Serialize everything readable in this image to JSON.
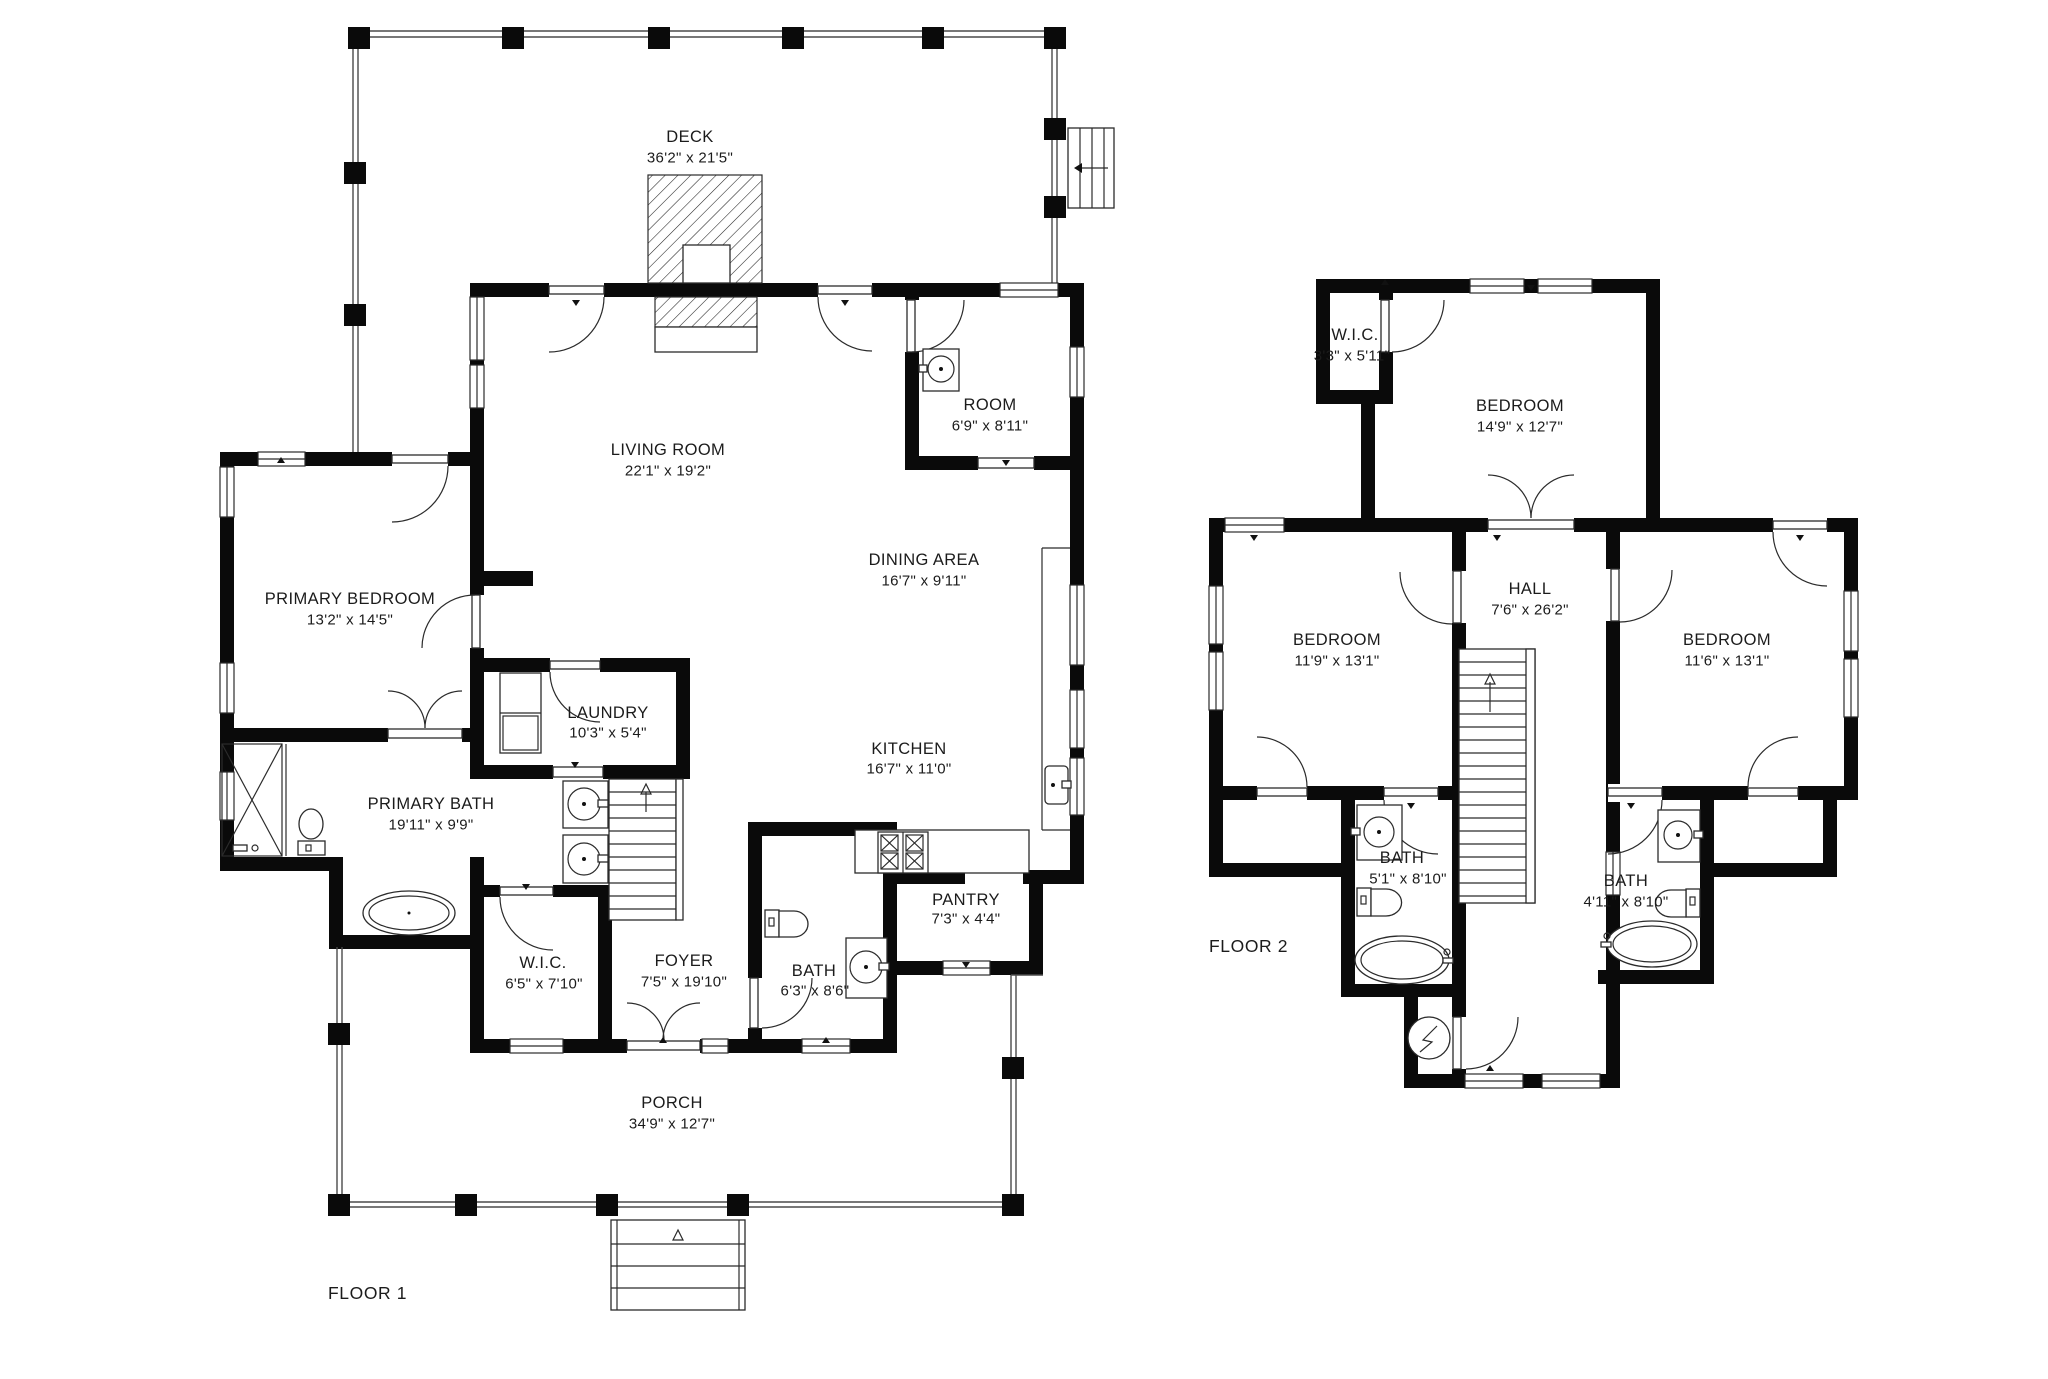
{
  "floor1": {
    "label": "FLOOR 1",
    "rooms": {
      "deck": {
        "name": "DECK",
        "dims": "36'2\" x 21'5\""
      },
      "living_room": {
        "name": "LIVING ROOM",
        "dims": "22'1\" x 19'2\""
      },
      "room": {
        "name": "ROOM",
        "dims": "6'9\" x 8'11\""
      },
      "dining_area": {
        "name": "DINING AREA",
        "dims": "16'7\" x 9'11\""
      },
      "primary_bedroom": {
        "name": "PRIMARY BEDROOM",
        "dims": "13'2\" x 14'5\""
      },
      "laundry": {
        "name": "LAUNDRY",
        "dims": "10'3\" x 5'4\""
      },
      "kitchen": {
        "name": "KITCHEN",
        "dims": "16'7\" x 11'0\""
      },
      "primary_bath": {
        "name": "PRIMARY BATH",
        "dims": "19'11\" x 9'9\""
      },
      "wic": {
        "name": "W.I.C.",
        "dims": "6'5\" x 7'10\""
      },
      "foyer": {
        "name": "FOYER",
        "dims": "7'5\" x 19'10\""
      },
      "bath": {
        "name": "BATH",
        "dims": "6'3\" x 8'6\""
      },
      "pantry": {
        "name": "PANTRY",
        "dims": "7'3\" x 4'4\""
      },
      "porch": {
        "name": "PORCH",
        "dims": "34'9\" x 12'7\""
      }
    }
  },
  "floor2": {
    "label": "FLOOR 2",
    "rooms": {
      "wic": {
        "name": "W.I.C.",
        "dims": "3'3\" x 5'11\""
      },
      "bedroom_top": {
        "name": "BEDROOM",
        "dims": "14'9\" x 12'7\""
      },
      "hall": {
        "name": "HALL",
        "dims": "7'6\" x 26'2\""
      },
      "bedroom_left": {
        "name": "BEDROOM",
        "dims": "11'9\" x 13'1\""
      },
      "bedroom_right": {
        "name": "BEDROOM",
        "dims": "11'6\" x 13'1\""
      },
      "bath_left": {
        "name": "BATH",
        "dims": "5'1\" x 8'10\""
      },
      "bath_right": {
        "name": "BATH",
        "dims": "4'11\" x 8'10\""
      }
    }
  }
}
